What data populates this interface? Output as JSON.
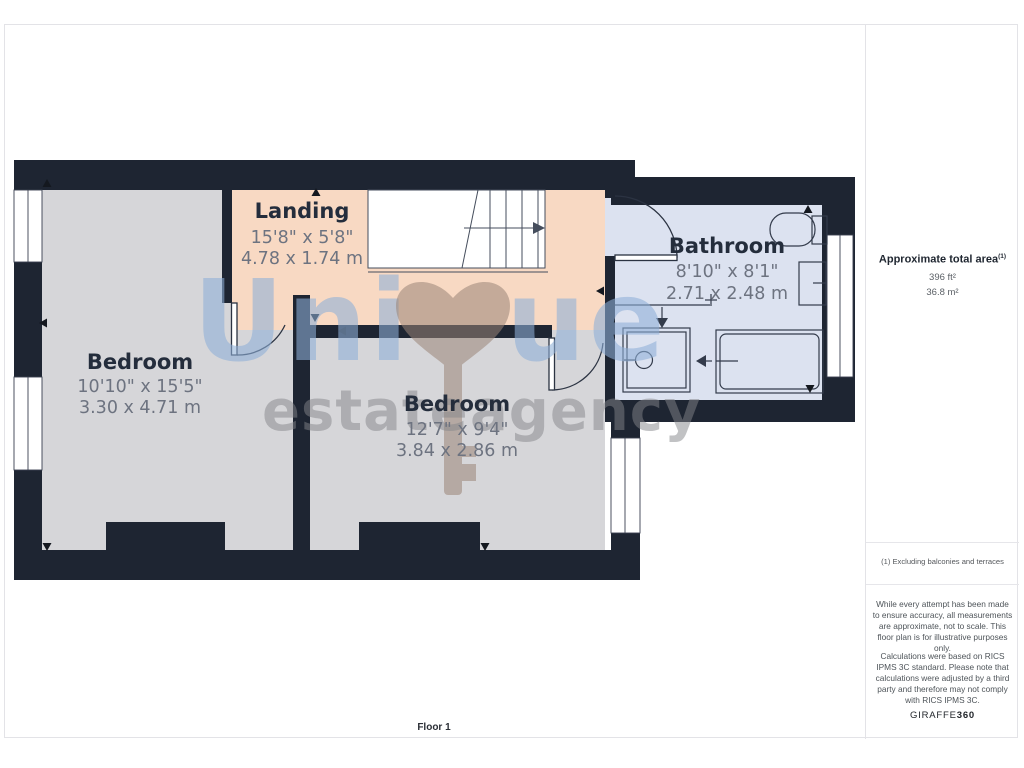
{
  "page": {
    "floor_label": "Floor 1"
  },
  "rooms": [
    {
      "name": "Bedroom",
      "imperial": "10'10\" x 15'5\"",
      "metric": "3.30 x 4.71 m"
    },
    {
      "name": "Landing",
      "imperial": "15'8\" x 5'8\"",
      "metric": "4.78 x 1.74 m"
    },
    {
      "name": "Bedroom",
      "imperial": "12'7\" x 9'4\"",
      "metric": "3.84 x 2.86 m"
    },
    {
      "name": "Bathroom",
      "imperial": "8'10\" x 8'1\"",
      "metric": "2.71 x 2.48 m"
    }
  ],
  "watermark": {
    "word1_part1": "Uni",
    "word1_part2": "ue",
    "word2": "estate",
    "word3": "agency",
    "symbol": "heart-key"
  },
  "sidebar": {
    "area_title": "Approximate total area",
    "area_title_sup": "(1)",
    "area_ft": "396 ft²",
    "area_m": "36.8 m²",
    "note": "(1) Excluding balconies and terraces",
    "disclaimer1": "While every attempt has been made to ensure accuracy, all measurements are approximate, not to scale. This floor plan is for illustrative purposes only.",
    "disclaimer2": "Calculations were based on RICS IPMS 3C standard. Please note that calculations were adjusted by a third party and therefore may not comply with RICS IPMS 3C.",
    "brand": "GIRAFFE",
    "brand_bold": "360"
  },
  "colors": {
    "wall": "#1e2532",
    "bedroom_floor": "#d6d6d9",
    "landing_floor": "#f8d9c3",
    "bathroom_floor": "#dce2f0",
    "watermark_blue": "#8fb0d8",
    "watermark_gray": "#85868a",
    "watermark_brown": "#9b8577"
  }
}
